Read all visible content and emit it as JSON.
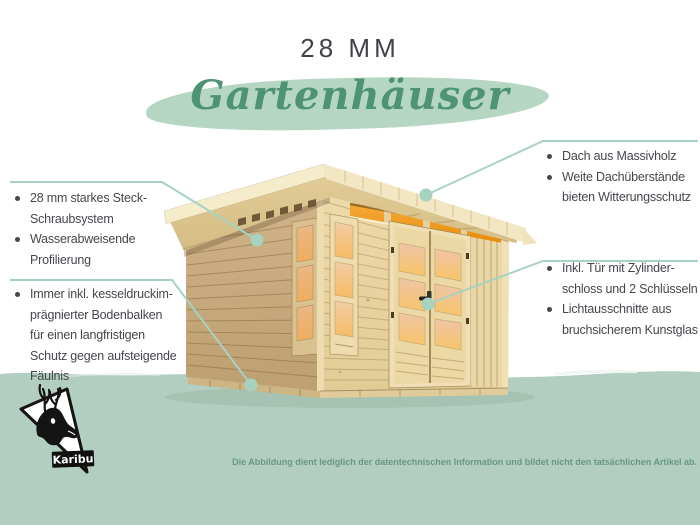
{
  "header": {
    "title": "28 MM",
    "subtitle": "Gartenhäuser"
  },
  "left_callouts": [
    {
      "items": [
        {
          "lines": [
            "28 mm starkes Steck-",
            "Schraubsystem"
          ]
        },
        {
          "lines": [
            "Wasserabweisende",
            "Profilierung"
          ]
        }
      ]
    },
    {
      "items": [
        {
          "lines": [
            "Immer inkl. kesseldruckim-",
            "prägnierter Bodenbalken",
            "für einen langfristigen",
            "Schutz gegen aufsteigende",
            "Fäulnis"
          ]
        }
      ]
    }
  ],
  "right_callouts": [
    {
      "items": [
        {
          "lines": [
            "Dach aus Massivholz"
          ]
        },
        {
          "lines": [
            "Weite Dachüberstände",
            "bieten Witterungsschutz"
          ]
        }
      ]
    },
    {
      "items": [
        {
          "lines": [
            "Inkl. Tür mit Zylinder-",
            "schloss und 2 Schlüsseln"
          ]
        },
        {
          "lines": [
            "Lichtausschnitte aus",
            "bruchsicherem Kunstglas"
          ]
        }
      ]
    }
  ],
  "logo": {
    "brand": "Karibu"
  },
  "footer": {
    "disclaimer": "Die Abbildung dient lediglich der datentechnischen Information und bildet nicht den tatsächlichen Artikel ab."
  },
  "colors": {
    "title_text": "#41414a",
    "subtitle_text": "#4f9377",
    "subtitle_brush": "#b6d6c4",
    "body_text": "#45474d",
    "callout_line": "#a8d2c0",
    "band": "#b2cec0",
    "band_shadow": "#a0bbac",
    "disclaimer_text": "#67987f",
    "wall_front": "#eddaa9",
    "wall_shaded": "#c9ad7e",
    "roof_wood": "#ddc792",
    "fascia": "#f2e7c2",
    "window_glow": "#f3a93f",
    "logo_black": "#141414"
  }
}
